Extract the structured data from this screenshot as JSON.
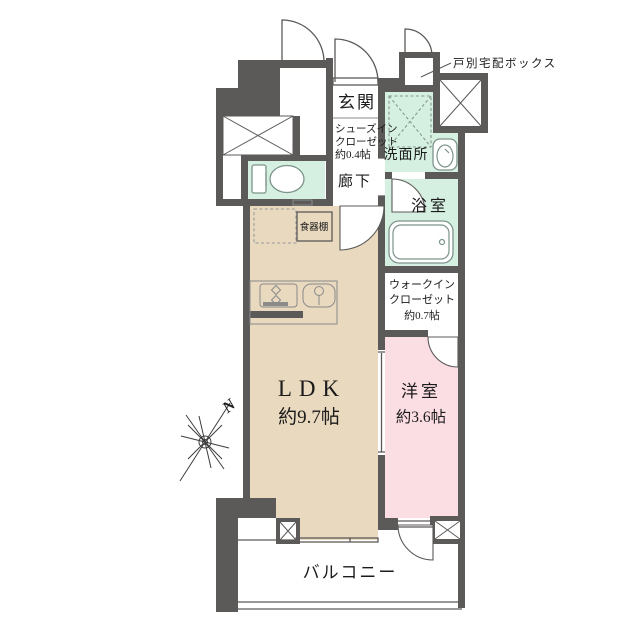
{
  "floorplan": {
    "rooms": {
      "entrance": "玄関",
      "shoe_closet_line1": "シューズイン",
      "shoe_closet_line2": "クローゼット",
      "shoe_closet_line3": "約0.4帖",
      "hallway": "廊下",
      "washroom": "洗面所",
      "bathroom": "浴室",
      "wic_line1": "ウォークイン",
      "wic_line2": "クローゼット",
      "wic_line3": "約0.7帖",
      "ldk_name": "LDK",
      "ldk_size": "約9.7帖",
      "bedroom_name": "洋室",
      "bedroom_size": "約3.6帖",
      "balcony": "バルコニー",
      "cupboard": "食器棚"
    },
    "annotations": {
      "delivery_box": "戸別宅配ボックス",
      "compass_north": "N"
    },
    "colors": {
      "wall": "#5c5959",
      "ldk_floor": "#e8d9bf",
      "bedroom_floor": "#fbdde4",
      "wet_floor": "#d5efe1",
      "background": "#ffffff"
    }
  }
}
